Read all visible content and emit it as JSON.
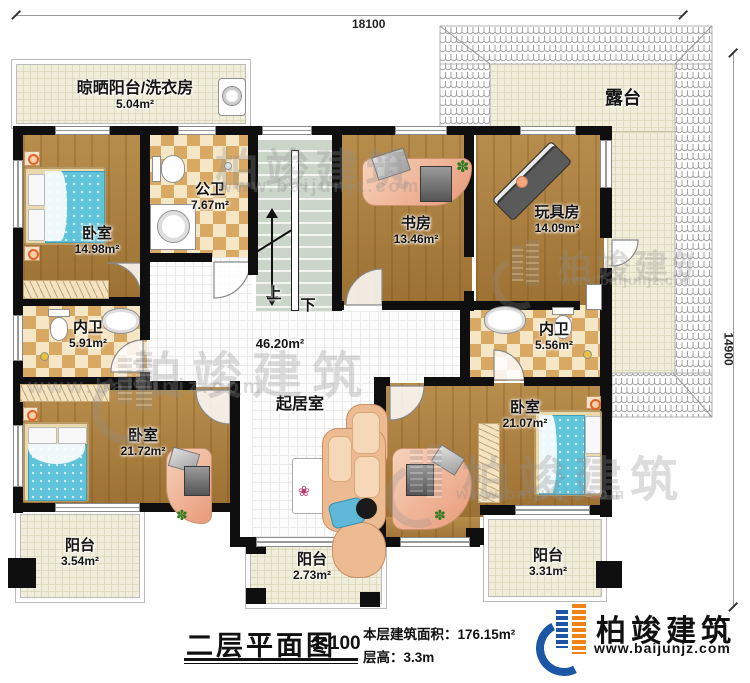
{
  "dimensions": {
    "top": "18100",
    "right": "14900"
  },
  "rooms": {
    "laundry": {
      "name": "晾晒阳台/洗衣房",
      "area": "5.04m²"
    },
    "terrace": {
      "name": "露台"
    },
    "bedroom_tl": {
      "name": "卧室",
      "area": "14.98m²"
    },
    "public_bath": {
      "name": "公卫",
      "area": "7.67m²"
    },
    "study": {
      "name": "书房",
      "area": "13.46m²"
    },
    "toy_room": {
      "name": "玩具房",
      "area": "14.09m²"
    },
    "inner_bath_left": {
      "name": "内卫",
      "area": "5.91m²"
    },
    "inner_bath_right": {
      "name": "内卫",
      "area": "5.56m²"
    },
    "hall_area": "46.20m²",
    "living": {
      "name": "起居室"
    },
    "bedroom_bl": {
      "name": "卧室",
      "area": "21.72m²"
    },
    "bedroom_br": {
      "name": "卧室",
      "area": "21.07m²"
    },
    "balcony_left": {
      "name": "阳台",
      "area": "3.54m²"
    },
    "balcony_front": {
      "name": "阳台",
      "area": "2.73m²"
    },
    "balcony_right": {
      "name": "阳台",
      "area": "3.31m²"
    }
  },
  "stairs": {
    "up": "上",
    "down": "下"
  },
  "footer": {
    "title": "二层平面图",
    "scale": "1:100",
    "area_line": "本层建筑面积：176.15m²",
    "height_line": "层高：3.3m"
  },
  "brand": {
    "name": "柏竣建筑",
    "site": "www.baijunjz.com"
  },
  "watermark": {
    "name": "柏竣建筑",
    "site": "www.baijunjz.com"
  },
  "icons": {
    "plant": "✽",
    "flower": "❀"
  },
  "colors": {
    "wall": "#0f0f0f",
    "wood_floor": "#a87c3a",
    "tile_cream": "#f0edda",
    "checker_tan": "#d9a964",
    "bed_blue": "#5fc3da",
    "brand_blue": "#1b57a5",
    "brand_orange": "#f08418"
  }
}
